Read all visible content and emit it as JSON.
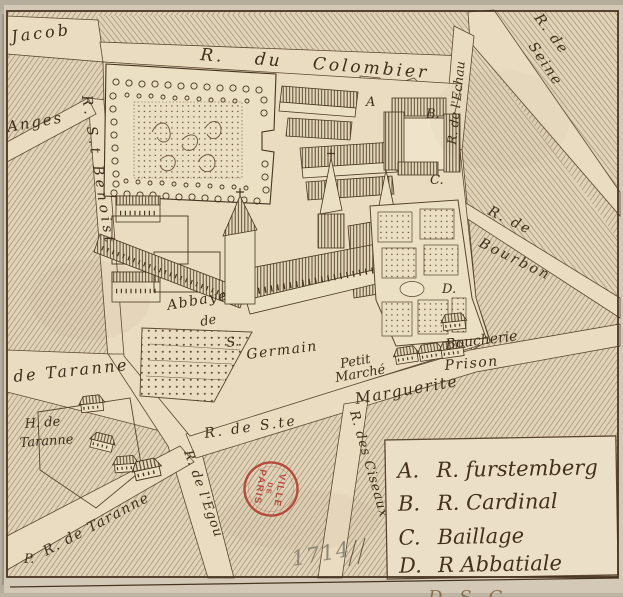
{
  "colors": {
    "paper": "#e0d3b8",
    "street_paper": "#e9dcc1",
    "ink": "#463521",
    "hatch_line": "#7d6548",
    "stamp_red": "#b0352a",
    "pencil_gray": "#8f8676",
    "margin": "#d3c9b6"
  },
  "streets": {
    "jacob": "Jacob",
    "colombier": "R. du Colombier",
    "seine_1": "R. de",
    "seine_2": "Seine",
    "echaude": "R. de l'Echau",
    "benoist": "R. S.t Benoist",
    "anges": "Anges",
    "bourbon_1": "R. de",
    "bourbon_2": "Bourbon",
    "taranne": "de Taranne",
    "p_prefix": "P.",
    "petite_rue_taranne": "R. de Taranne",
    "egout": "R. de l'Egou",
    "sainte": "R. de S.te",
    "marguerite": "Marguerite",
    "ciseaux": "R. des Ciseaux"
  },
  "places": {
    "abbaye_1": "Abbaye",
    "abbaye_2": "de",
    "abbaye_3": "S.",
    "abbaye_4": "Germain",
    "hotel_taranne_1": "H. de",
    "hotel_taranne_2": "Taranne",
    "petit_marche_1": "Petit",
    "petit_marche_2": "Marché",
    "boucherie": "Boucherie",
    "prison": "Prison"
  },
  "markers": {
    "a": "A",
    "b": "B.",
    "c": "C.",
    "d": "D."
  },
  "legend": {
    "items": [
      {
        "key": "A.",
        "label": "R. furstemberg"
      },
      {
        "key": "B.",
        "label": "R. Cardinal"
      },
      {
        "key": "C.",
        "label": "Baillage"
      },
      {
        "key": "D.",
        "label": "R Abbatiale"
      }
    ]
  },
  "stamp": {
    "line1": "VILLE",
    "line2": "DE",
    "line3": "PARIS"
  },
  "annotations": {
    "date": "1714",
    "margin_note": "D. S. G"
  }
}
